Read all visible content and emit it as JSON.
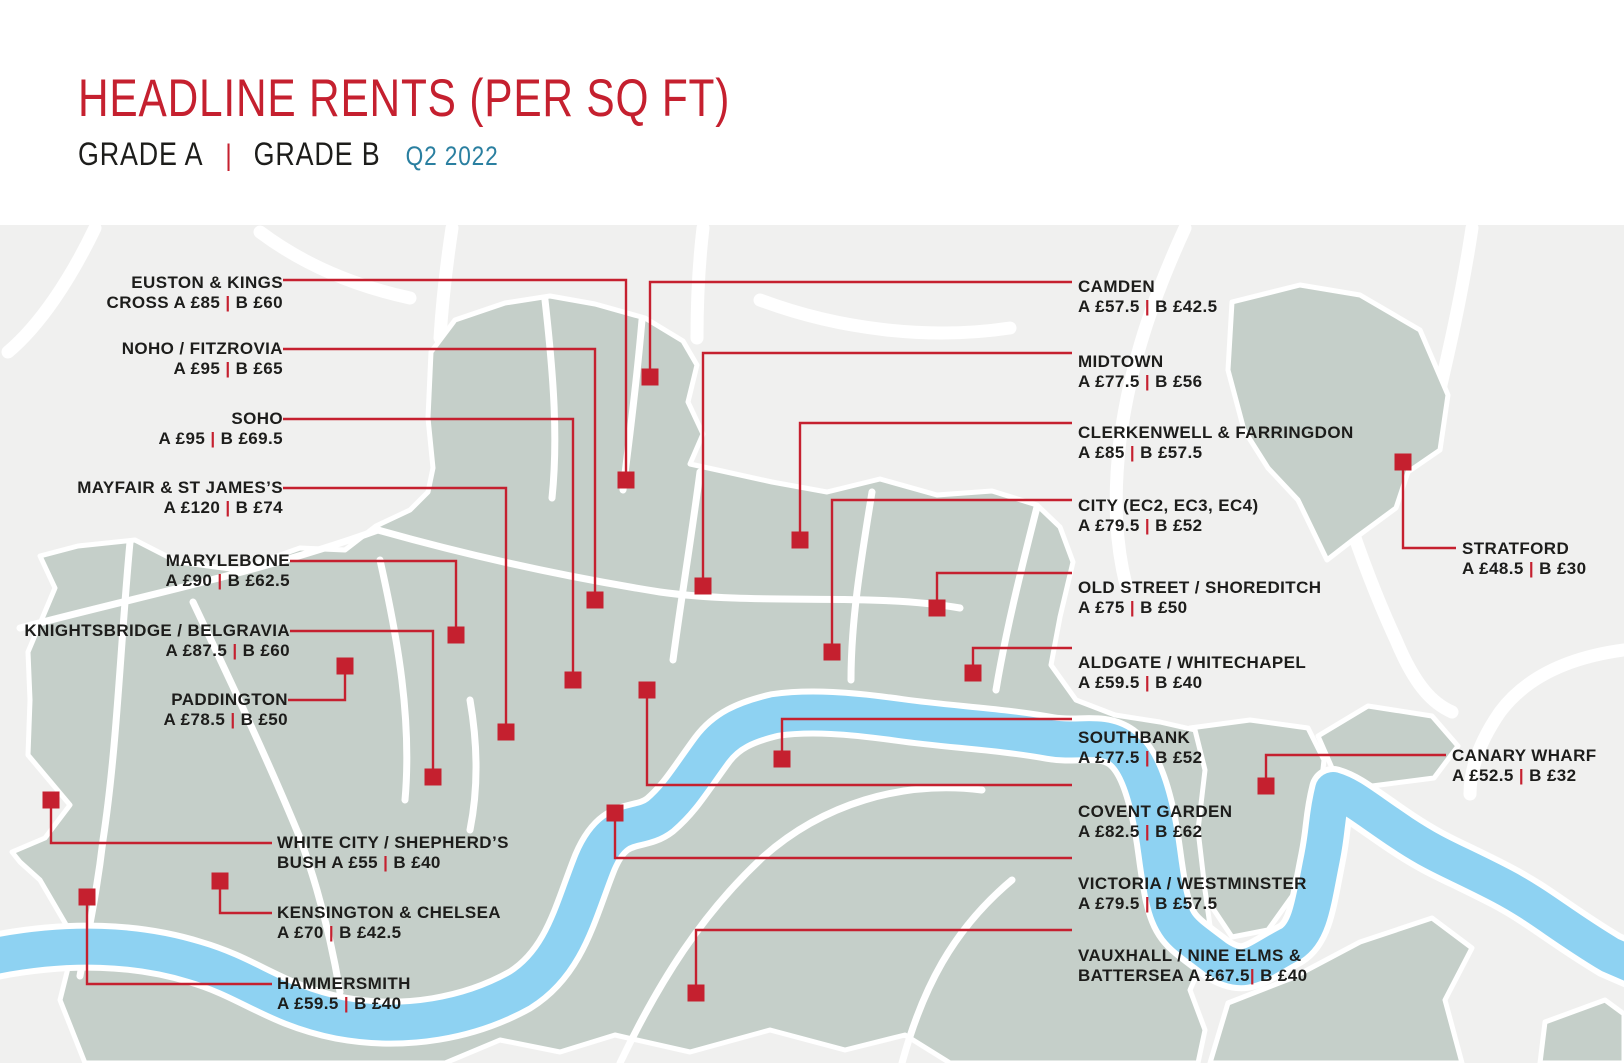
{
  "header": {
    "title": "HEADLINE RENTS (PER SQ FT)",
    "grade_a": "GRADE A",
    "divider": "|",
    "grade_b": "GRADE B",
    "period": "Q2 2022"
  },
  "colors": {
    "accent_red": "#c5202f",
    "text_dark": "#1d1d1b",
    "period_blue": "#2a7fa0",
    "land": "#c5cfc9",
    "river": "#8ed2f2",
    "map_background": "#f0f0ef",
    "border_white": "#ffffff"
  },
  "legend_note": "A = Grade A rent, B = Grade B rent, £ per sq ft",
  "areas": [
    {
      "id": "euston-kings-cross",
      "name": "Euston & Kings Cross",
      "rent_a": 85,
      "rent_b": 60,
      "lines": [
        "EUSTON & KINGS",
        "CROSS A £85 | B £60"
      ],
      "label": {
        "x": 283,
        "y": 273,
        "align": "right"
      },
      "marker": {
        "x": 626,
        "y": 480
      },
      "leader": [
        [
          283,
          280
        ],
        [
          626,
          280
        ],
        [
          626,
          480
        ]
      ]
    },
    {
      "id": "noho-fitzrovia",
      "name": "NoHo / Fitzrovia",
      "rent_a": 95,
      "rent_b": 65,
      "lines": [
        "NOHO / FITZROVIA",
        "A £95 | B £65"
      ],
      "label": {
        "x": 283,
        "y": 339,
        "align": "right"
      },
      "marker": {
        "x": 595,
        "y": 600
      },
      "leader": [
        [
          283,
          349
        ],
        [
          595,
          349
        ],
        [
          595,
          600
        ]
      ]
    },
    {
      "id": "soho",
      "name": "Soho",
      "rent_a": 95,
      "rent_b": 69.5,
      "lines": [
        "SOHO",
        "A £95 | B £69.5"
      ],
      "label": {
        "x": 283,
        "y": 409,
        "align": "right"
      },
      "marker": {
        "x": 573,
        "y": 680
      },
      "leader": [
        [
          283,
          419
        ],
        [
          573,
          419
        ],
        [
          573,
          680
        ]
      ]
    },
    {
      "id": "mayfair-st-james",
      "name": "Mayfair & St James’s",
      "rent_a": 120,
      "rent_b": 74,
      "lines": [
        "MAYFAIR & ST JAMES’S",
        "A £120 | B £74"
      ],
      "label": {
        "x": 283,
        "y": 478,
        "align": "right"
      },
      "marker": {
        "x": 506,
        "y": 732
      },
      "leader": [
        [
          283,
          488
        ],
        [
          506,
          488
        ],
        [
          506,
          732
        ]
      ]
    },
    {
      "id": "marylebone",
      "name": "Marylebone",
      "rent_a": 90,
      "rent_b": 62.5,
      "lines": [
        "MARYLEBONE",
        "A £90 | B £62.5"
      ],
      "label": {
        "x": 290,
        "y": 551,
        "align": "right"
      },
      "marker": {
        "x": 456,
        "y": 635
      },
      "leader": [
        [
          290,
          561
        ],
        [
          456,
          561
        ],
        [
          456,
          635
        ]
      ]
    },
    {
      "id": "knightsbridge-belgravia",
      "name": "Knightsbridge / Belgravia",
      "rent_a": 87.5,
      "rent_b": 60,
      "lines": [
        "KNIGHTSBRIDGE / BELGRAVIA",
        "A £87.5 | B £60"
      ],
      "label": {
        "x": 290,
        "y": 621,
        "align": "right"
      },
      "marker": {
        "x": 433,
        "y": 777
      },
      "leader": [
        [
          290,
          631
        ],
        [
          433,
          631
        ],
        [
          433,
          777
        ]
      ]
    },
    {
      "id": "paddington",
      "name": "Paddington",
      "rent_a": 78.5,
      "rent_b": 50,
      "lines": [
        "PADDINGTON",
        "A £78.5 | B £50"
      ],
      "label": {
        "x": 288,
        "y": 690,
        "align": "right"
      },
      "marker": {
        "x": 345,
        "y": 666
      },
      "leader": [
        [
          288,
          700
        ],
        [
          345,
          700
        ],
        [
          345,
          670
        ]
      ]
    },
    {
      "id": "white-city-shepherds-bush",
      "name": "White City / Shepherd’s Bush",
      "rent_a": 55,
      "rent_b": 40,
      "lines": [
        "WHITE CITY / SHEPHERD’S",
        "BUSH A £55 | B £40"
      ],
      "label": {
        "x": 277,
        "y": 833,
        "align": "left"
      },
      "marker": {
        "x": 51,
        "y": 800
      },
      "leader": [
        [
          51,
          804
        ],
        [
          51,
          843
        ],
        [
          272,
          843
        ]
      ]
    },
    {
      "id": "kensington-chelsea",
      "name": "Kensington & Chelsea",
      "rent_a": 70,
      "rent_b": 42.5,
      "lines": [
        "KENSINGTON & CHELSEA",
        "A £70 | B £42.5"
      ],
      "label": {
        "x": 277,
        "y": 903,
        "align": "left"
      },
      "marker": {
        "x": 220,
        "y": 881
      },
      "leader": [
        [
          220,
          885
        ],
        [
          220,
          913
        ],
        [
          272,
          913
        ]
      ]
    },
    {
      "id": "hammersmith",
      "name": "Hammersmith",
      "rent_a": 59.5,
      "rent_b": 40,
      "lines": [
        "HAMMERSMITH",
        "A £59.5 | B £40"
      ],
      "label": {
        "x": 277,
        "y": 974,
        "align": "left"
      },
      "marker": {
        "x": 87,
        "y": 897
      },
      "leader": [
        [
          87,
          901
        ],
        [
          87,
          984
        ],
        [
          272,
          984
        ]
      ]
    },
    {
      "id": "camden",
      "name": "Camden",
      "rent_a": 57.5,
      "rent_b": 42.5,
      "lines": [
        "CAMDEN",
        "A £57.5 | B £42.5"
      ],
      "label": {
        "x": 1078,
        "y": 277,
        "align": "left"
      },
      "marker": {
        "x": 650,
        "y": 377
      },
      "leader": [
        [
          650,
          371
        ],
        [
          650,
          282
        ],
        [
          1072,
          282
        ]
      ]
    },
    {
      "id": "midtown",
      "name": "Midtown",
      "rent_a": 77.5,
      "rent_b": 56,
      "lines": [
        "MIDTOWN",
        "A £77.5 | B £56"
      ],
      "label": {
        "x": 1078,
        "y": 352,
        "align": "left"
      },
      "marker": {
        "x": 703,
        "y": 586
      },
      "leader": [
        [
          703,
          580
        ],
        [
          703,
          353
        ],
        [
          1072,
          353
        ]
      ]
    },
    {
      "id": "clerkenwell-farringdon",
      "name": "Clerkenwell & Farringdon",
      "rent_a": 85,
      "rent_b": 57.5,
      "lines": [
        "CLERKENWELL & FARRINGDON",
        "A £85 | B £57.5"
      ],
      "label": {
        "x": 1078,
        "y": 423,
        "align": "left"
      },
      "marker": {
        "x": 800,
        "y": 540
      },
      "leader": [
        [
          800,
          534
        ],
        [
          800,
          423
        ],
        [
          1072,
          423
        ]
      ]
    },
    {
      "id": "city-ec2-ec3-ec4",
      "name": "City (EC2, EC3, EC4)",
      "rent_a": 79.5,
      "rent_b": 52,
      "lines": [
        "CITY (EC2, EC3, EC4)",
        "A £79.5 | B £52"
      ],
      "label": {
        "x": 1078,
        "y": 496,
        "align": "left"
      },
      "marker": {
        "x": 832,
        "y": 652
      },
      "leader": [
        [
          832,
          646
        ],
        [
          832,
          500
        ],
        [
          1072,
          500
        ]
      ]
    },
    {
      "id": "old-street-shoreditch",
      "name": "Old Street / Shoreditch",
      "rent_a": 75,
      "rent_b": 50,
      "lines": [
        "OLD STREET / SHOREDITCH",
        "A £75 | B £50"
      ],
      "label": {
        "x": 1078,
        "y": 578,
        "align": "left"
      },
      "marker": {
        "x": 937,
        "y": 608
      },
      "leader": [
        [
          937,
          602
        ],
        [
          937,
          573
        ],
        [
          1072,
          573
        ]
      ]
    },
    {
      "id": "aldgate-whitechapel",
      "name": "Aldgate / Whitechapel",
      "rent_a": 59.5,
      "rent_b": 40,
      "lines": [
        "ALDGATE / WHITECHAPEL",
        "A £59.5 | B £40"
      ],
      "label": {
        "x": 1078,
        "y": 653,
        "align": "left"
      },
      "marker": {
        "x": 973,
        "y": 673
      },
      "leader": [
        [
          973,
          667
        ],
        [
          973,
          648
        ],
        [
          1072,
          648
        ]
      ]
    },
    {
      "id": "southbank",
      "name": "Southbank",
      "rent_a": 77.5,
      "rent_b": 52,
      "lines": [
        "SOUTHBANK",
        "A £77.5 | B £52"
      ],
      "label": {
        "x": 1078,
        "y": 728,
        "align": "left"
      },
      "marker": {
        "x": 782,
        "y": 759
      },
      "leader": [
        [
          782,
          753
        ],
        [
          782,
          719
        ],
        [
          1072,
          719
        ]
      ]
    },
    {
      "id": "covent-garden",
      "name": "Covent Garden",
      "rent_a": 82.5,
      "rent_b": 62,
      "lines": [
        "COVENT GARDEN",
        "A £82.5 | B £62"
      ],
      "label": {
        "x": 1078,
        "y": 802,
        "align": "left"
      },
      "marker": {
        "x": 647,
        "y": 690
      },
      "leader": [
        [
          647,
          696
        ],
        [
          647,
          785
        ],
        [
          1072,
          785
        ]
      ]
    },
    {
      "id": "victoria-westminster",
      "name": "Victoria / Westminster",
      "rent_a": 79.5,
      "rent_b": 57.5,
      "lines": [
        "VICTORIA / WESTMINSTER",
        "A £79.5 | B £57.5"
      ],
      "label": {
        "x": 1078,
        "y": 874,
        "align": "left"
      },
      "marker": {
        "x": 615,
        "y": 813
      },
      "leader": [
        [
          615,
          819
        ],
        [
          615,
          858
        ],
        [
          1072,
          858
        ]
      ]
    },
    {
      "id": "vauxhall-nine-elms-battersea",
      "name": "Vauxhall / Nine Elms & Battersea",
      "rent_a": 67.5,
      "rent_b": 40,
      "lines": [
        "VAUXHALL / NINE ELMS &",
        "BATTERSEA A £67.5| B £40"
      ],
      "label": {
        "x": 1078,
        "y": 946,
        "align": "left"
      },
      "marker": {
        "x": 696,
        "y": 993
      },
      "leader": [
        [
          696,
          987
        ],
        [
          696,
          930
        ],
        [
          1072,
          930
        ]
      ]
    },
    {
      "id": "stratford",
      "name": "Stratford",
      "rent_a": 48.5,
      "rent_b": 30,
      "lines": [
        "STRATFORD",
        "A £48.5 | B £30"
      ],
      "label": {
        "x": 1462,
        "y": 539,
        "align": "left"
      },
      "marker": {
        "x": 1403,
        "y": 462
      },
      "leader": [
        [
          1403,
          468
        ],
        [
          1403,
          548
        ],
        [
          1456,
          548
        ]
      ]
    },
    {
      "id": "canary-wharf",
      "name": "Canary Wharf",
      "rent_a": 52.5,
      "rent_b": 32,
      "lines": [
        "CANARY WHARF",
        "A £52.5 | B £32"
      ],
      "label": {
        "x": 1452,
        "y": 746,
        "align": "left"
      },
      "marker": {
        "x": 1266,
        "y": 786
      },
      "leader": [
        [
          1266,
          780
        ],
        [
          1266,
          755
        ],
        [
          1446,
          755
        ]
      ]
    }
  ]
}
